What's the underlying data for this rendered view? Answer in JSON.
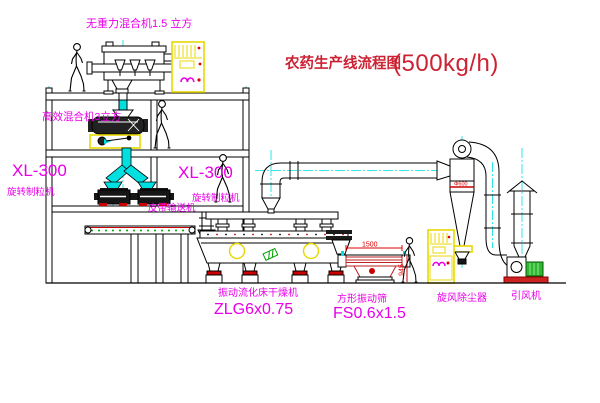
{
  "diagram": {
    "title": {
      "name": "农药生产线流程图",
      "capacity": "(500kg/h)"
    },
    "equipment": {
      "mixer1": "无重力混合机1.5 立方",
      "mixer2": "高效混合机3立方",
      "granulator1": {
        "model": "XL-300",
        "name": "旋转制粒机"
      },
      "granulator2": {
        "model": "XL-300",
        "name": "旋转制粒机"
      },
      "conveyor": "皮带输送机",
      "dryer": {
        "name": "振动流化床干燥机",
        "model": "ZLG6x0.75"
      },
      "sieve": {
        "name": "方形振动筛",
        "model": "FS0.6x1.5"
      },
      "cyclone": {
        "name": "旋风除尘器",
        "diameter": "Φ600"
      },
      "fan": "引风机"
    },
    "dimensions": {
      "sieve_length": "1500",
      "sieve_height": "945"
    },
    "colors": {
      "label_magenta": "#e800e8",
      "title_red": "#cc2233",
      "dimension_red": "#dd0000",
      "centerline_cyan": "#00dede",
      "cabinet_yellow": "#e8d800",
      "motor_green": "#2db82d",
      "line_black": "#000000"
    }
  }
}
